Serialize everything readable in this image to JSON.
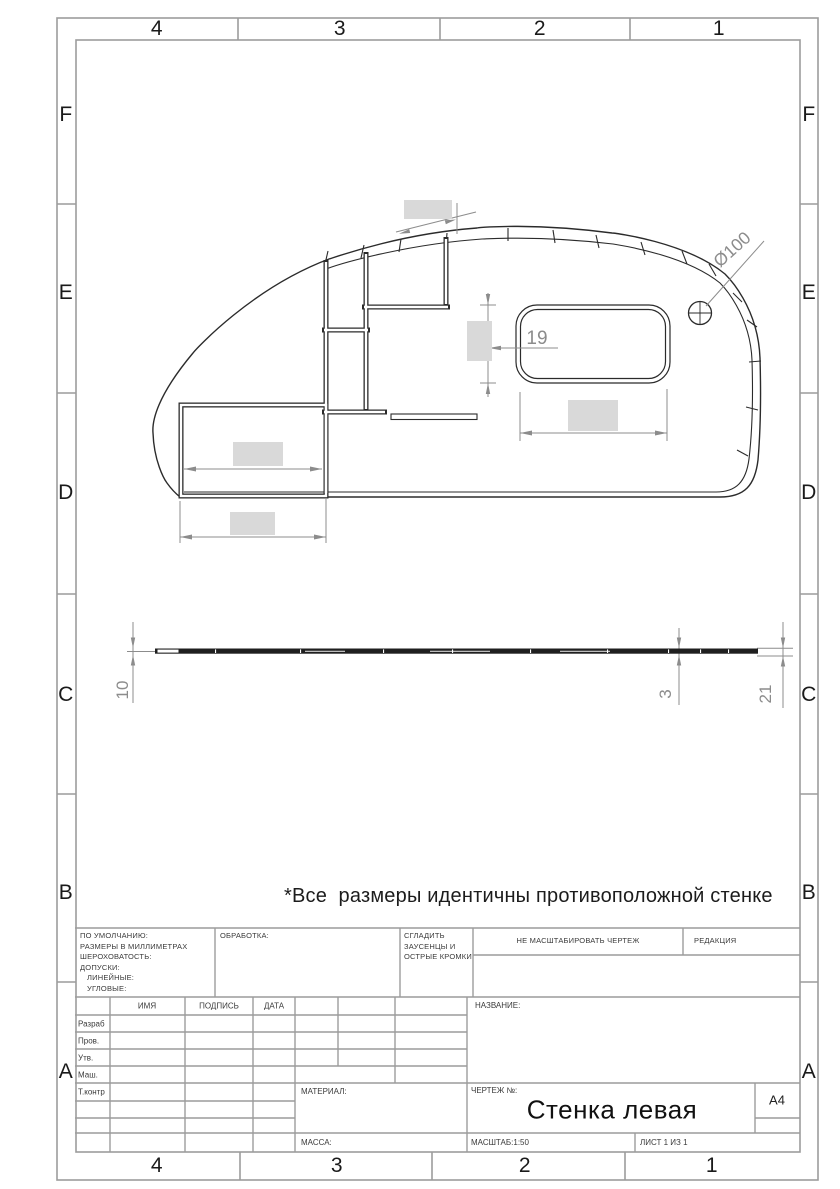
{
  "colors": {
    "drawing_line": "#2b2b2b",
    "frame_line": "#9c9c9c",
    "dimension": "#8c8c8c",
    "redacted_fill": "#d9d9d9"
  },
  "zones": {
    "columns": [
      "4",
      "3",
      "2",
      "1"
    ],
    "rows": [
      "F",
      "E",
      "D",
      "C",
      "B",
      "A"
    ]
  },
  "note": "*Все  размеры идентичны противоположной стенке",
  "dimensions": {
    "hole_diameter": "Ø100",
    "window_gap": "19",
    "thickness_left": "10",
    "thickness_right": "3",
    "edge_right": "21"
  },
  "title_block": {
    "defaults_lines": [
      "ПО УМОЛЧАНИЮ:",
      "РАЗМЕРЫ В МИЛЛИМЕТРАХ",
      "ШЕРОХОВАТОСТЬ:",
      "ДОПУСКИ:",
      "ЛИНЕЙНЫЕ:",
      "УГЛОВЫЕ:"
    ],
    "finishing_label": "ОБРАБОТКА:",
    "deburr_lines": [
      "СГЛАДИТЬ",
      "ЗАУСЕНЦЫ И",
      "ОСТРЫЕ КРОМКИ"
    ],
    "do_not_scale": "НЕ МАСШТАБИРОВАТЬ ЧЕРТЕЖ",
    "revision_label": "РЕДАКЦИЯ",
    "columns": {
      "name": "ИМЯ",
      "signature": "ПОДПИСЬ",
      "date": "ДАТА"
    },
    "roles": [
      "Разраб",
      "Пров.",
      "Утв.",
      "Маш.",
      "Т.контр"
    ],
    "title_label": "НАЗВАНИЕ:",
    "material_label": "МАТЕРИАЛ:",
    "mass_label": "МАССА:",
    "drawing_no_label": "ЧЕРТЕЖ №:",
    "drawing_title": "Стенка левая",
    "format": "А4",
    "scale": "МАСШТАБ:1:50",
    "sheet": "ЛИСТ 1 ИЗ 1"
  }
}
